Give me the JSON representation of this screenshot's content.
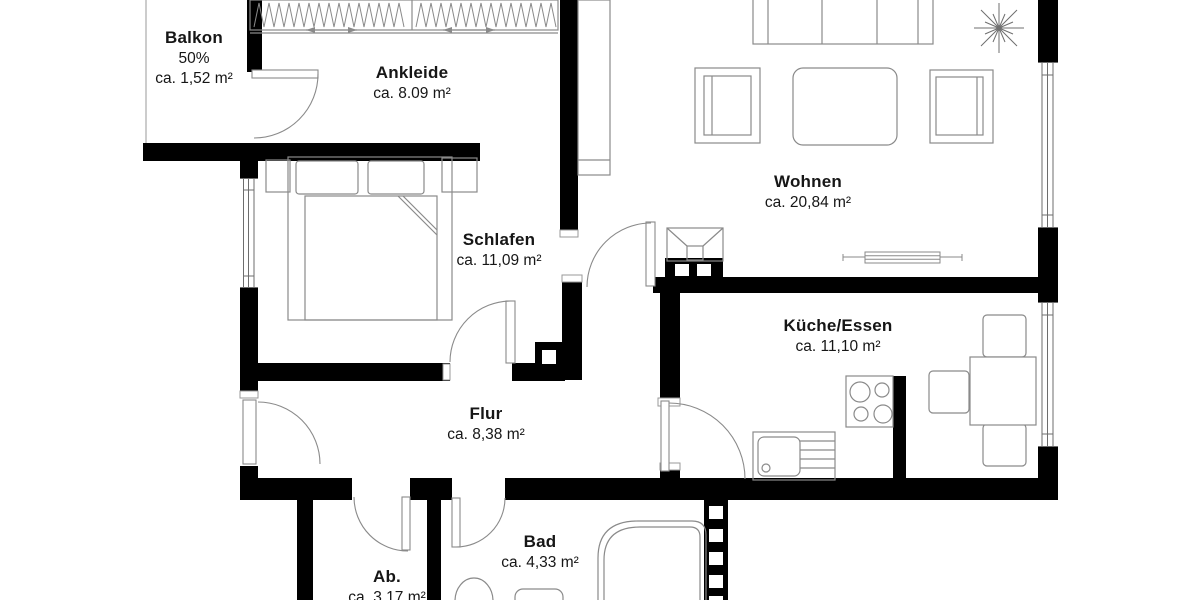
{
  "plan": {
    "title": "Wohnung Grundriss",
    "background_color": "#ffffff",
    "wall_color": "#000000",
    "furniture_line_color": "#8a8a8a",
    "text_color": "#161616",
    "rooms": [
      {
        "id": "balkon",
        "name": "Balkon",
        "note": "50%",
        "area": "ca. 1,52 m²"
      },
      {
        "id": "ankleide",
        "name": "Ankleide",
        "area": "ca. 8.09 m²"
      },
      {
        "id": "schlafen",
        "name": "Schlafen",
        "area": "ca. 11,09 m²"
      },
      {
        "id": "wohnen",
        "name": "Wohnen",
        "area": "ca. 20,84 m²"
      },
      {
        "id": "kueche",
        "name": "Küche/Essen",
        "area": "ca. 11,10 m²"
      },
      {
        "id": "flur",
        "name": "Flur",
        "area": "ca. 8,38 m²"
      },
      {
        "id": "bad",
        "name": "Bad",
        "area": "ca. 4,33 m²"
      },
      {
        "id": "ab",
        "name": "Ab.",
        "area": "ca. 3,17 m²"
      }
    ]
  }
}
